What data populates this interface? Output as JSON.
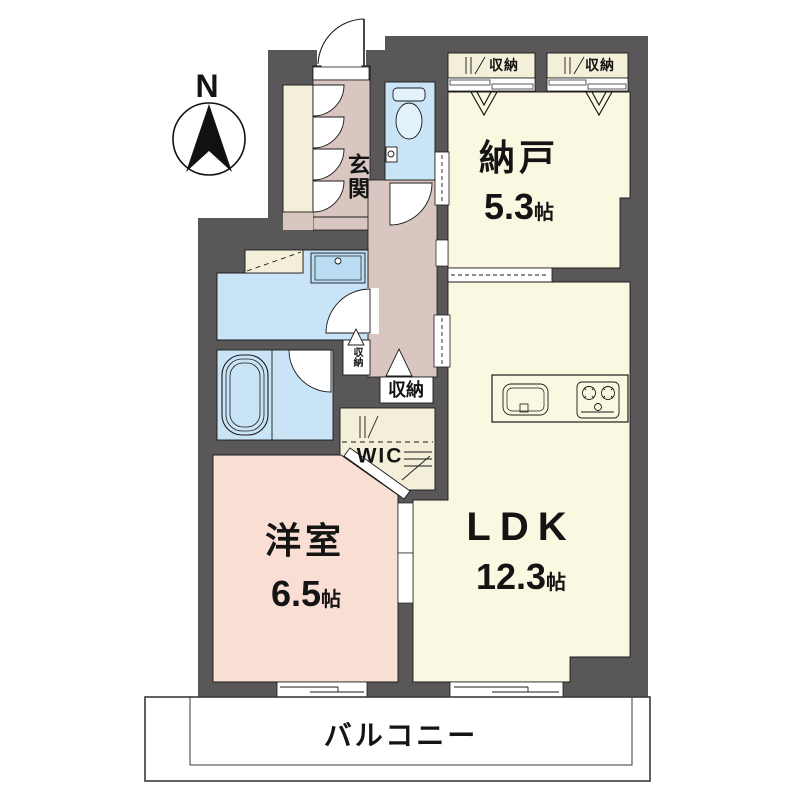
{
  "compass": {
    "label": "N"
  },
  "rooms": {
    "genkan": {
      "name": "玄関"
    },
    "nando": {
      "name": "納戸",
      "size_value": "5.3",
      "size_unit": "帖"
    },
    "ldk": {
      "name": "LDK",
      "size_value": "12.3",
      "size_unit": "帖"
    },
    "western_room": {
      "name": "洋室",
      "size_value": "6.5",
      "size_unit": "帖"
    },
    "wic": {
      "name": "WIC"
    },
    "balcony": {
      "name": "バルコニー"
    }
  },
  "storage": {
    "nando_closet_left": "収納",
    "nando_closet_right": "収納",
    "hallway_closet_small": "収納",
    "hallway_closet_large": "収納"
  },
  "colors": {
    "wall": "#595757",
    "floor_cream": "#FBF8E1",
    "hall_pink": "#D9C6C1",
    "room_pink": "#F9DED3",
    "water_blue": "#C9E4F6",
    "closet_cream": "#F3EFD9",
    "fixture_blue": "#E3F1FB",
    "line": "#1A1A1A"
  }
}
